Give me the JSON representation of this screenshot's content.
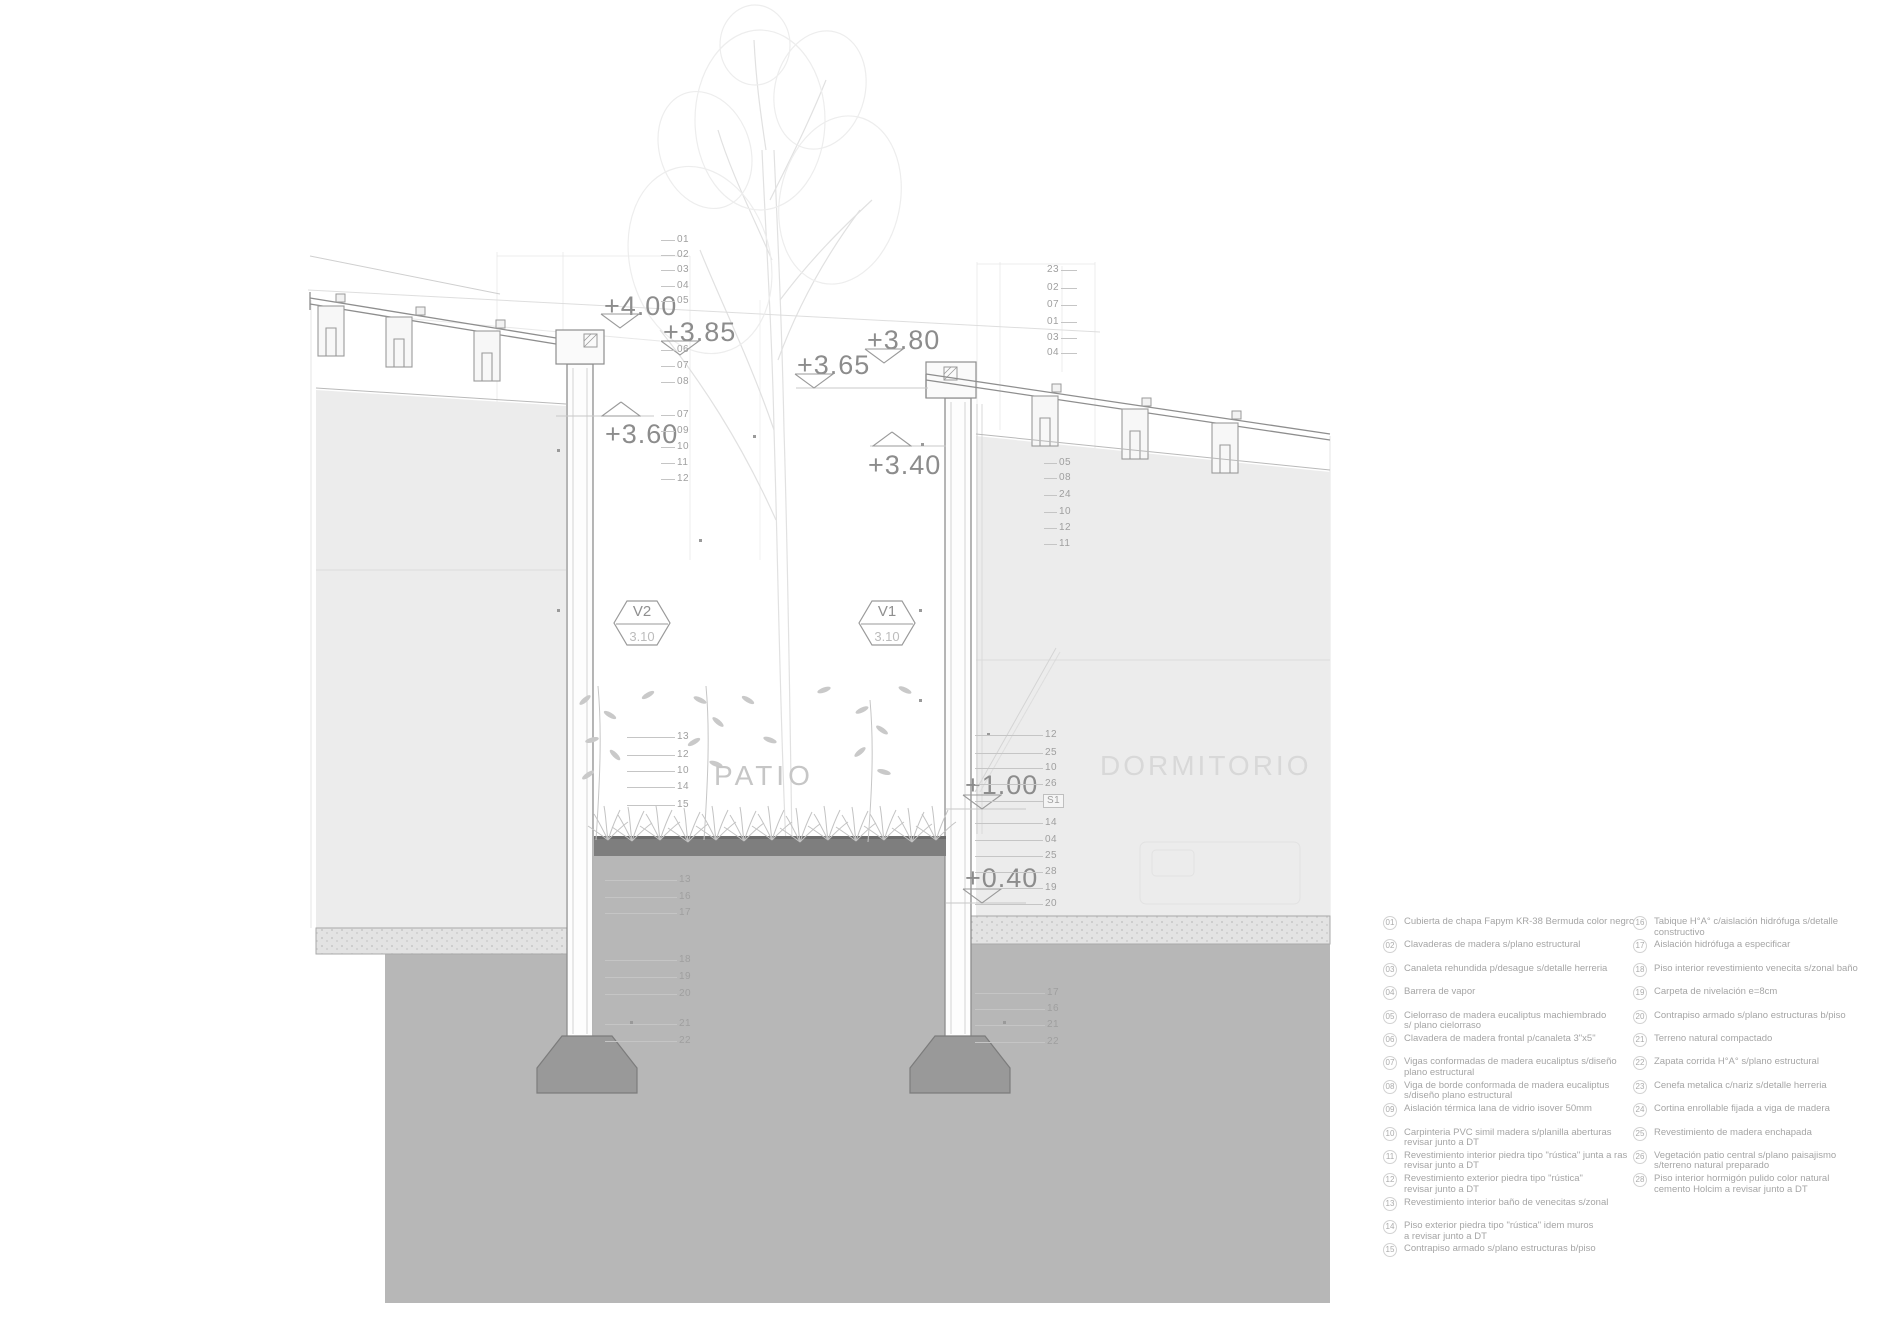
{
  "colors": {
    "background": "#ffffff",
    "line": "#8e8e8e",
    "soil": "#b7b7b7",
    "footing": "#999999",
    "patio_floor": "#7e7e7e",
    "elevation_text": "#8c8c8c",
    "callout_text": "#9f9f9f",
    "legend_text": "#a5a5a5",
    "room_label": "#cdcdcd"
  },
  "rooms": {
    "patio": "PATIO",
    "dormitorio": "DORMITORIO"
  },
  "window_tags": [
    {
      "code": "V2",
      "value": "3.10",
      "x": 613,
      "y": 599
    },
    {
      "code": "V1",
      "value": "3.10",
      "x": 858,
      "y": 599
    }
  ],
  "elevation_markers": [
    {
      "label": "+4.00",
      "x": 604,
      "y": 291,
      "tri": "down",
      "tx": 600,
      "ty": 313
    },
    {
      "label": "+3.85",
      "x": 663,
      "y": 317,
      "tri": "down",
      "tx": 660,
      "ty": 340
    },
    {
      "label": "+3.80",
      "x": 867,
      "y": 325,
      "tri": "down",
      "tx": 864,
      "ty": 348
    },
    {
      "label": "+3.65",
      "x": 797,
      "y": 350,
      "tri": "down",
      "tx": 794,
      "ty": 373
    },
    {
      "label": "+3.60",
      "x": 605,
      "y": 419,
      "tri": "up",
      "tx": 601,
      "ty": 401
    },
    {
      "label": "+3.40",
      "x": 868,
      "y": 450,
      "tri": "up",
      "tx": 872,
      "ty": 431
    },
    {
      "label": "+1.00",
      "x": 965,
      "y": 770,
      "tri": "down",
      "tx": 962,
      "ty": 794
    },
    {
      "label": "+0.40",
      "x": 965,
      "y": 863,
      "tri": "down",
      "tx": 962,
      "ty": 888
    }
  ],
  "callouts": [
    {
      "label": "01",
      "x": 675,
      "y": 240,
      "dir": "l",
      "len": 14
    },
    {
      "label": "02",
      "x": 675,
      "y": 255,
      "dir": "l",
      "len": 14
    },
    {
      "label": "03",
      "x": 675,
      "y": 270,
      "dir": "l",
      "len": 14
    },
    {
      "label": "04",
      "x": 675,
      "y": 286,
      "dir": "l",
      "len": 14
    },
    {
      "label": "05",
      "x": 675,
      "y": 301,
      "dir": "l",
      "len": 14
    },
    {
      "label": "06",
      "x": 675,
      "y": 350,
      "dir": "l",
      "len": 14
    },
    {
      "label": "07",
      "x": 675,
      "y": 366,
      "dir": "l",
      "len": 14
    },
    {
      "label": "08",
      "x": 675,
      "y": 382,
      "dir": "l",
      "len": 14
    },
    {
      "label": "07",
      "x": 675,
      "y": 415,
      "dir": "l",
      "len": 14
    },
    {
      "label": "09",
      "x": 675,
      "y": 431,
      "dir": "l",
      "len": 14
    },
    {
      "label": "10",
      "x": 675,
      "y": 447,
      "dir": "l",
      "len": 14
    },
    {
      "label": "11",
      "x": 675,
      "y": 463,
      "dir": "l",
      "len": 14
    },
    {
      "label": "12",
      "x": 675,
      "y": 479,
      "dir": "l",
      "len": 14
    },
    {
      "label": "13",
      "x": 675,
      "y": 737,
      "dir": "l",
      "len": 48
    },
    {
      "label": "12",
      "x": 675,
      "y": 755,
      "dir": "l",
      "len": 48
    },
    {
      "label": "10",
      "x": 675,
      "y": 771,
      "dir": "l",
      "len": 48
    },
    {
      "label": "14",
      "x": 675,
      "y": 787,
      "dir": "l",
      "len": 48
    },
    {
      "label": "15",
      "x": 675,
      "y": 805,
      "dir": "l",
      "len": 48
    },
    {
      "label": "13",
      "x": 677,
      "y": 880,
      "dir": "l",
      "len": 72
    },
    {
      "label": "16",
      "x": 677,
      "y": 897,
      "dir": "l",
      "len": 72
    },
    {
      "label": "17",
      "x": 677,
      "y": 913,
      "dir": "l",
      "len": 72
    },
    {
      "label": "18",
      "x": 677,
      "y": 960,
      "dir": "l",
      "len": 72
    },
    {
      "label": "19",
      "x": 677,
      "y": 977,
      "dir": "l",
      "len": 72
    },
    {
      "label": "20",
      "x": 677,
      "y": 994,
      "dir": "l",
      "len": 72
    },
    {
      "label": "21",
      "x": 677,
      "y": 1024,
      "dir": "l",
      "len": 72
    },
    {
      "label": "22",
      "x": 677,
      "y": 1041,
      "dir": "l",
      "len": 72
    },
    {
      "label": "23",
      "x": 1045,
      "y": 270,
      "dir": "r",
      "len": 16
    },
    {
      "label": "02",
      "x": 1045,
      "y": 288,
      "dir": "r",
      "len": 16
    },
    {
      "label": "07",
      "x": 1045,
      "y": 305,
      "dir": "r",
      "len": 16
    },
    {
      "label": "01",
      "x": 1045,
      "y": 322,
      "dir": "r",
      "len": 16
    },
    {
      "label": "03",
      "x": 1045,
      "y": 338,
      "dir": "r",
      "len": 16
    },
    {
      "label": "04",
      "x": 1045,
      "y": 353,
      "dir": "r",
      "len": 16
    },
    {
      "label": "05",
      "x": 1057,
      "y": 463,
      "dir": "l",
      "len": 13
    },
    {
      "label": "08",
      "x": 1057,
      "y": 478,
      "dir": "l",
      "len": 13
    },
    {
      "label": "24",
      "x": 1057,
      "y": 495,
      "dir": "l",
      "len": 13
    },
    {
      "label": "10",
      "x": 1057,
      "y": 512,
      "dir": "l",
      "len": 13
    },
    {
      "label": "12",
      "x": 1057,
      "y": 528,
      "dir": "l",
      "len": 13
    },
    {
      "label": "11",
      "x": 1057,
      "y": 544,
      "dir": "l",
      "len": 13
    },
    {
      "label": "12",
      "x": 1043,
      "y": 735,
      "dir": "l",
      "len": 68
    },
    {
      "label": "25",
      "x": 1043,
      "y": 753,
      "dir": "l",
      "len": 68
    },
    {
      "label": "10",
      "x": 1043,
      "y": 768,
      "dir": "l",
      "len": 68
    },
    {
      "label": "26",
      "x": 1043,
      "y": 784,
      "dir": "l",
      "len": 68
    },
    {
      "label": "S1",
      "x": 1043,
      "y": 801,
      "dir": "l",
      "len": 68,
      "boxed": true
    },
    {
      "label": "14",
      "x": 1043,
      "y": 823,
      "dir": "l",
      "len": 68
    },
    {
      "label": "04",
      "x": 1043,
      "y": 840,
      "dir": "l",
      "len": 68
    },
    {
      "label": "25",
      "x": 1043,
      "y": 856,
      "dir": "l",
      "len": 68
    },
    {
      "label": "28",
      "x": 1043,
      "y": 872,
      "dir": "l",
      "len": 68
    },
    {
      "label": "19",
      "x": 1043,
      "y": 888,
      "dir": "l",
      "len": 68
    },
    {
      "label": "20",
      "x": 1043,
      "y": 904,
      "dir": "l",
      "len": 68
    },
    {
      "label": "17",
      "x": 1045,
      "y": 993,
      "dir": "l",
      "len": 70
    },
    {
      "label": "16",
      "x": 1045,
      "y": 1009,
      "dir": "l",
      "len": 70
    },
    {
      "label": "21",
      "x": 1045,
      "y": 1025,
      "dir": "l",
      "len": 70
    },
    {
      "label": "22",
      "x": 1045,
      "y": 1042,
      "dir": "l",
      "len": 70
    }
  ],
  "legend": {
    "columns": [
      [
        {
          "num": "01",
          "text": "Cubierta de chapa Fapym KR-38 Bermuda color negro"
        },
        {
          "num": "02",
          "text": "Clavaderas de madera s/plano estructural"
        },
        {
          "num": "03",
          "text": "Canaleta rehundida p/desague s/detalle herreria"
        },
        {
          "num": "04",
          "text": "Barrera de vapor"
        },
        {
          "num": "05",
          "text": "Cielorraso de madera eucaliptus machiembrado\ns/ plano cielorraso"
        },
        {
          "num": "06",
          "text": "Clavadera de madera frontal p/canaleta 3\"x5\""
        },
        {
          "num": "07",
          "text": "Vigas conformadas de madera eucaliptus s/diseño\nplano estructural"
        },
        {
          "num": "08",
          "text": "Viga de borde conformada de  madera eucaliptus\ns/diseño plano estructural"
        },
        {
          "num": "09",
          "text": "Aislación térmica lana de vidrio isover 50mm"
        },
        {
          "num": "10",
          "text": "Carpinteria PVC simil madera s/planilla aberturas\nrevisar junto a DT"
        },
        {
          "num": "11",
          "text": "Revestimiento interior piedra tipo \"rústica\" junta a ras\nrevisar junto a DT"
        },
        {
          "num": "12",
          "text": "Revestimiento exterior piedra tipo \"rústica\"\nrevisar junto a DT"
        },
        {
          "num": "13",
          "text": "Revestimiento interior baño de venecitas s/zonal"
        },
        {
          "num": "14",
          "text": "Piso exterior piedra tipo \"rústica\" idem muros\na revisar junto a DT"
        },
        {
          "num": "15",
          "text": "Contrapiso armado s/plano estructuras b/piso"
        }
      ],
      [
        {
          "num": "16",
          "text": "Tabique H°A° c/aislación hidrófuga s/detalle constructivo"
        },
        {
          "num": "17",
          "text": "Aislación hidrófuga a especificar"
        },
        {
          "num": "18",
          "text": "Piso interior revestimiento venecita s/zonal baño"
        },
        {
          "num": "19",
          "text": "Carpeta de nivelación e=8cm"
        },
        {
          "num": "20",
          "text": "Contrapiso armado s/plano estructuras b/piso"
        },
        {
          "num": "21",
          "text": "Terreno natural compactado"
        },
        {
          "num": "22",
          "text": "Zapata corrida H°A° s/plano estructural"
        },
        {
          "num": "23",
          "text": "Cenefa metalica c/nariz s/detalle herreria"
        },
        {
          "num": "24",
          "text": "Cortina enrollable fijada a viga de madera"
        },
        {
          "num": "25",
          "text": "Revestimiento de madera enchapada"
        },
        {
          "num": "26",
          "text": "Vegetación patio central s/plano paisajismo\ns/terreno natural preparado"
        },
        {
          "num": "28",
          "text": "Piso interior hormigón pulido color natural\ncemento Holcim a revisar junto a DT"
        }
      ]
    ]
  }
}
